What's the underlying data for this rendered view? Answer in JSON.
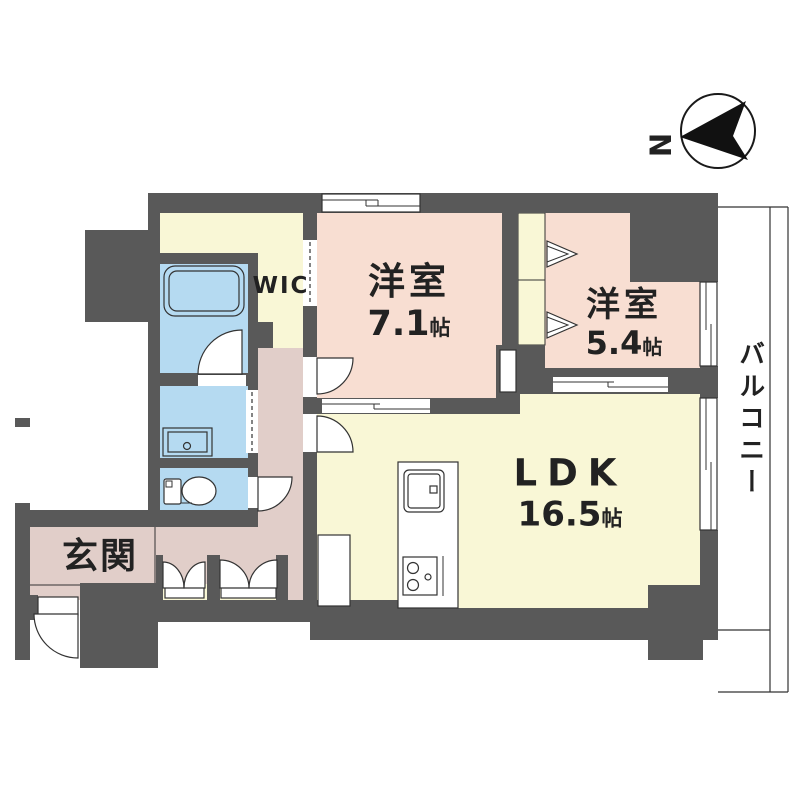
{
  "compass": {
    "north_label": "N"
  },
  "rooms": {
    "bedroom_main": {
      "name": "洋室",
      "size_value": "7.1",
      "size_unit": "帖"
    },
    "bedroom_second": {
      "name": "洋室",
      "size_value": "5.4",
      "size_unit": "帖"
    },
    "ldk": {
      "name": "LDK",
      "size_value": "16.5",
      "size_unit": "帖"
    },
    "wic": {
      "name": "WIC"
    },
    "entrance": {
      "name": "玄関"
    },
    "balcony": {
      "name": "バルコニー"
    }
  },
  "colors": {
    "wall": "#595959",
    "bedroom_fill": "#f8ded2",
    "ldk_fill": "#f9f7d6",
    "hall_fill": "#e1cec9",
    "wet_fill": "#b5daf1",
    "tub_fill": "#cfe8f7",
    "balcony_fill": "#ffffff",
    "line": "#333333",
    "text": "#222222"
  }
}
